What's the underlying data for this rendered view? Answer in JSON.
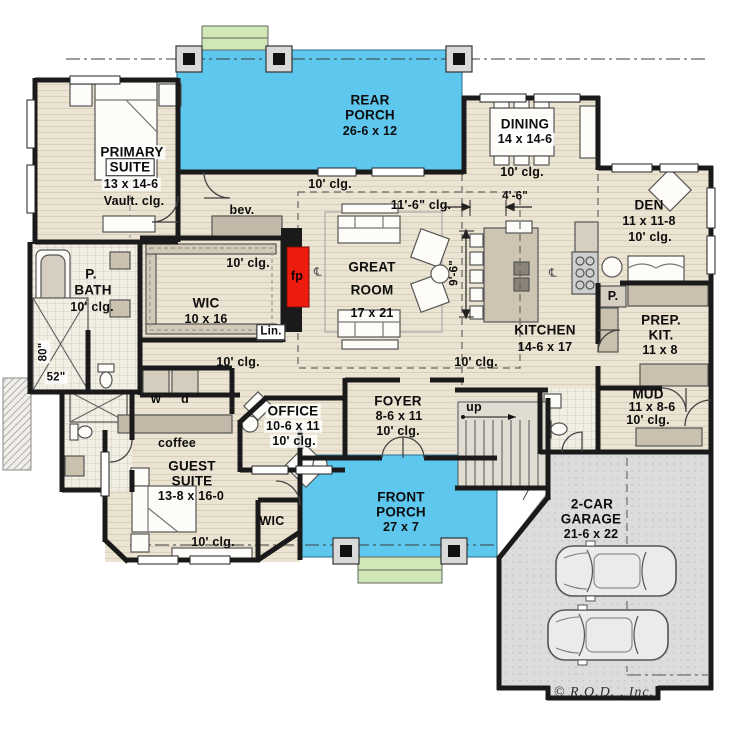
{
  "colors": {
    "porch_blue": "#5ec7ee",
    "floor_tan": "#ece4d2",
    "wall_black": "#1a1a1a",
    "garage_gray": "#dcdcdc",
    "steps_green": "#cfe8b5",
    "fireplace_red": "#ee1c0e",
    "counter_tan": "#c9c0ae"
  },
  "rooms": {
    "rear_porch": {
      "line1": "REAR",
      "line2": "PORCH",
      "dims": "26-6 x 12"
    },
    "dining": {
      "name": "DINING",
      "dims": "14 x 14-6",
      "clg": "10' clg."
    },
    "primary_suite": {
      "line1": "PRIMARY",
      "line2": "SUITE",
      "dims": "13 x 14-6",
      "clg": "Vault. clg."
    },
    "den": {
      "name": "DEN",
      "dims": "11 x 11-8",
      "clg": "10' clg."
    },
    "great_room": {
      "line1": "GREAT",
      "line2": "ROOM",
      "dims": "17 x 21",
      "clg": "11'-6\" clg."
    },
    "wic": {
      "name": "WIC",
      "dims": "10 x 16",
      "clg": "10' clg."
    },
    "p_bath": {
      "line1": "P.",
      "line2": "BATH",
      "clg": "10' clg."
    },
    "kitchen": {
      "name": "KITCHEN",
      "dims": "14-6 x 17",
      "clg": "10' clg."
    },
    "prep_kitchen": {
      "line1": "PREP.",
      "line2": "KIT.",
      "dims": "11 x 8"
    },
    "mud": {
      "name": "MUD",
      "dims": "11 x 8-6",
      "clg": "10' clg."
    },
    "office": {
      "name": "OFFICE",
      "dims": "10-6 x 11",
      "clg": "10' clg."
    },
    "foyer": {
      "name": "FOYER",
      "dims": "8-6 x 11",
      "clg": "10' clg."
    },
    "guest_suite": {
      "line1": "GUEST",
      "line2": "SUITE",
      "dims": "13-8 x 16-0",
      "clg": "10' clg."
    },
    "guest_wic": {
      "name": "WIC"
    },
    "front_porch": {
      "line1": "FRONT",
      "line2": "PORCH",
      "dims": "27 x 7"
    },
    "garage": {
      "line1": "2-CAR",
      "line2": "GARAGE",
      "dims": "21-6 x 22"
    }
  },
  "annotations": {
    "rear_clg": "10' clg.",
    "hall_clg": "10' clg.",
    "bev": "bev.",
    "coffee": "coffee",
    "linen": "Lin.",
    "pantry": "P.",
    "washer": "w",
    "dryer": "d",
    "up": "up",
    "fireplace": "fp",
    "dim_4_6": "4'-6\"",
    "dim_9_6": "9'-6\"",
    "shower_width": "80\"",
    "shower_length": "52\"",
    "centerline": "℄",
    "copyright": "© R.O.D. , Inc."
  }
}
